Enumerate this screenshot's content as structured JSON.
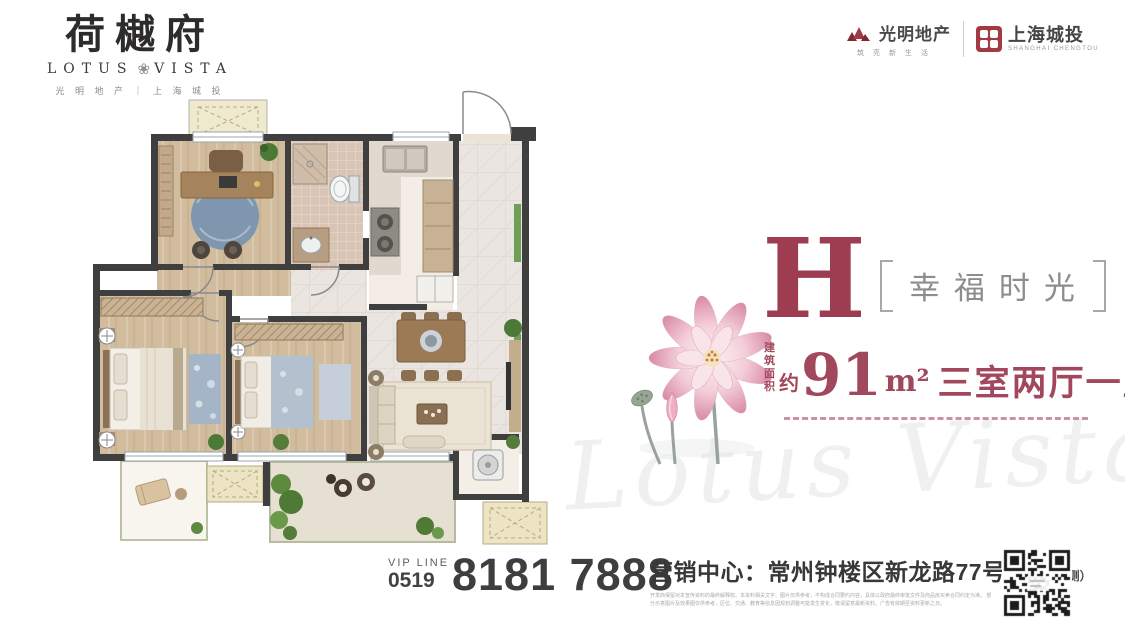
{
  "brand": {
    "name_cn": "荷樾府",
    "name_en_left": "LOTUS",
    "name_en_right": "VISTA",
    "developers": "光 明 地 产 ｜ 上 海 城 投"
  },
  "partners": {
    "p1_name": "光明地产",
    "p1_tagline": "筑亮新生活",
    "p2_name": "上海城投",
    "p2_sub": "SHANGHAI CHENGTOU"
  },
  "unit": {
    "letter": "H",
    "tagline": "幸福时光",
    "area_label_top": "建筑",
    "area_label_bottom": "面积",
    "area_approx": "约",
    "area_value": "91",
    "area_unit": "m²",
    "layout_text": "三室两厅一卫"
  },
  "contact": {
    "vip_label": "VIP LINE",
    "vip_code": "0519",
    "phone": "8181 7888",
    "sales_line": "营销中心：常州钟楼区新龙路77号",
    "address_note": "（荷园正南侧）",
    "disclaimer1": "开发商保留对本宣传资料的最终解释权。本资料相关文字、图片仅供参考，不构成合同要约内容，具体以政府最终审批文件及商品房买卖合同约定为准。",
    "disclaimer2": "部分示意图片及效果图仅供参考，区位、交通、教育等信息因规划调整可能发生变化，敬请留意最新资料。广告有效期至资料更新之日。"
  },
  "watermark_text": "Lotus Vista",
  "icons": {
    "lotus_ornament": "❀"
  },
  "colors": {
    "accent": "#9e3c52",
    "logo_red": "#a23a44",
    "ink": "#3d3d3d"
  }
}
